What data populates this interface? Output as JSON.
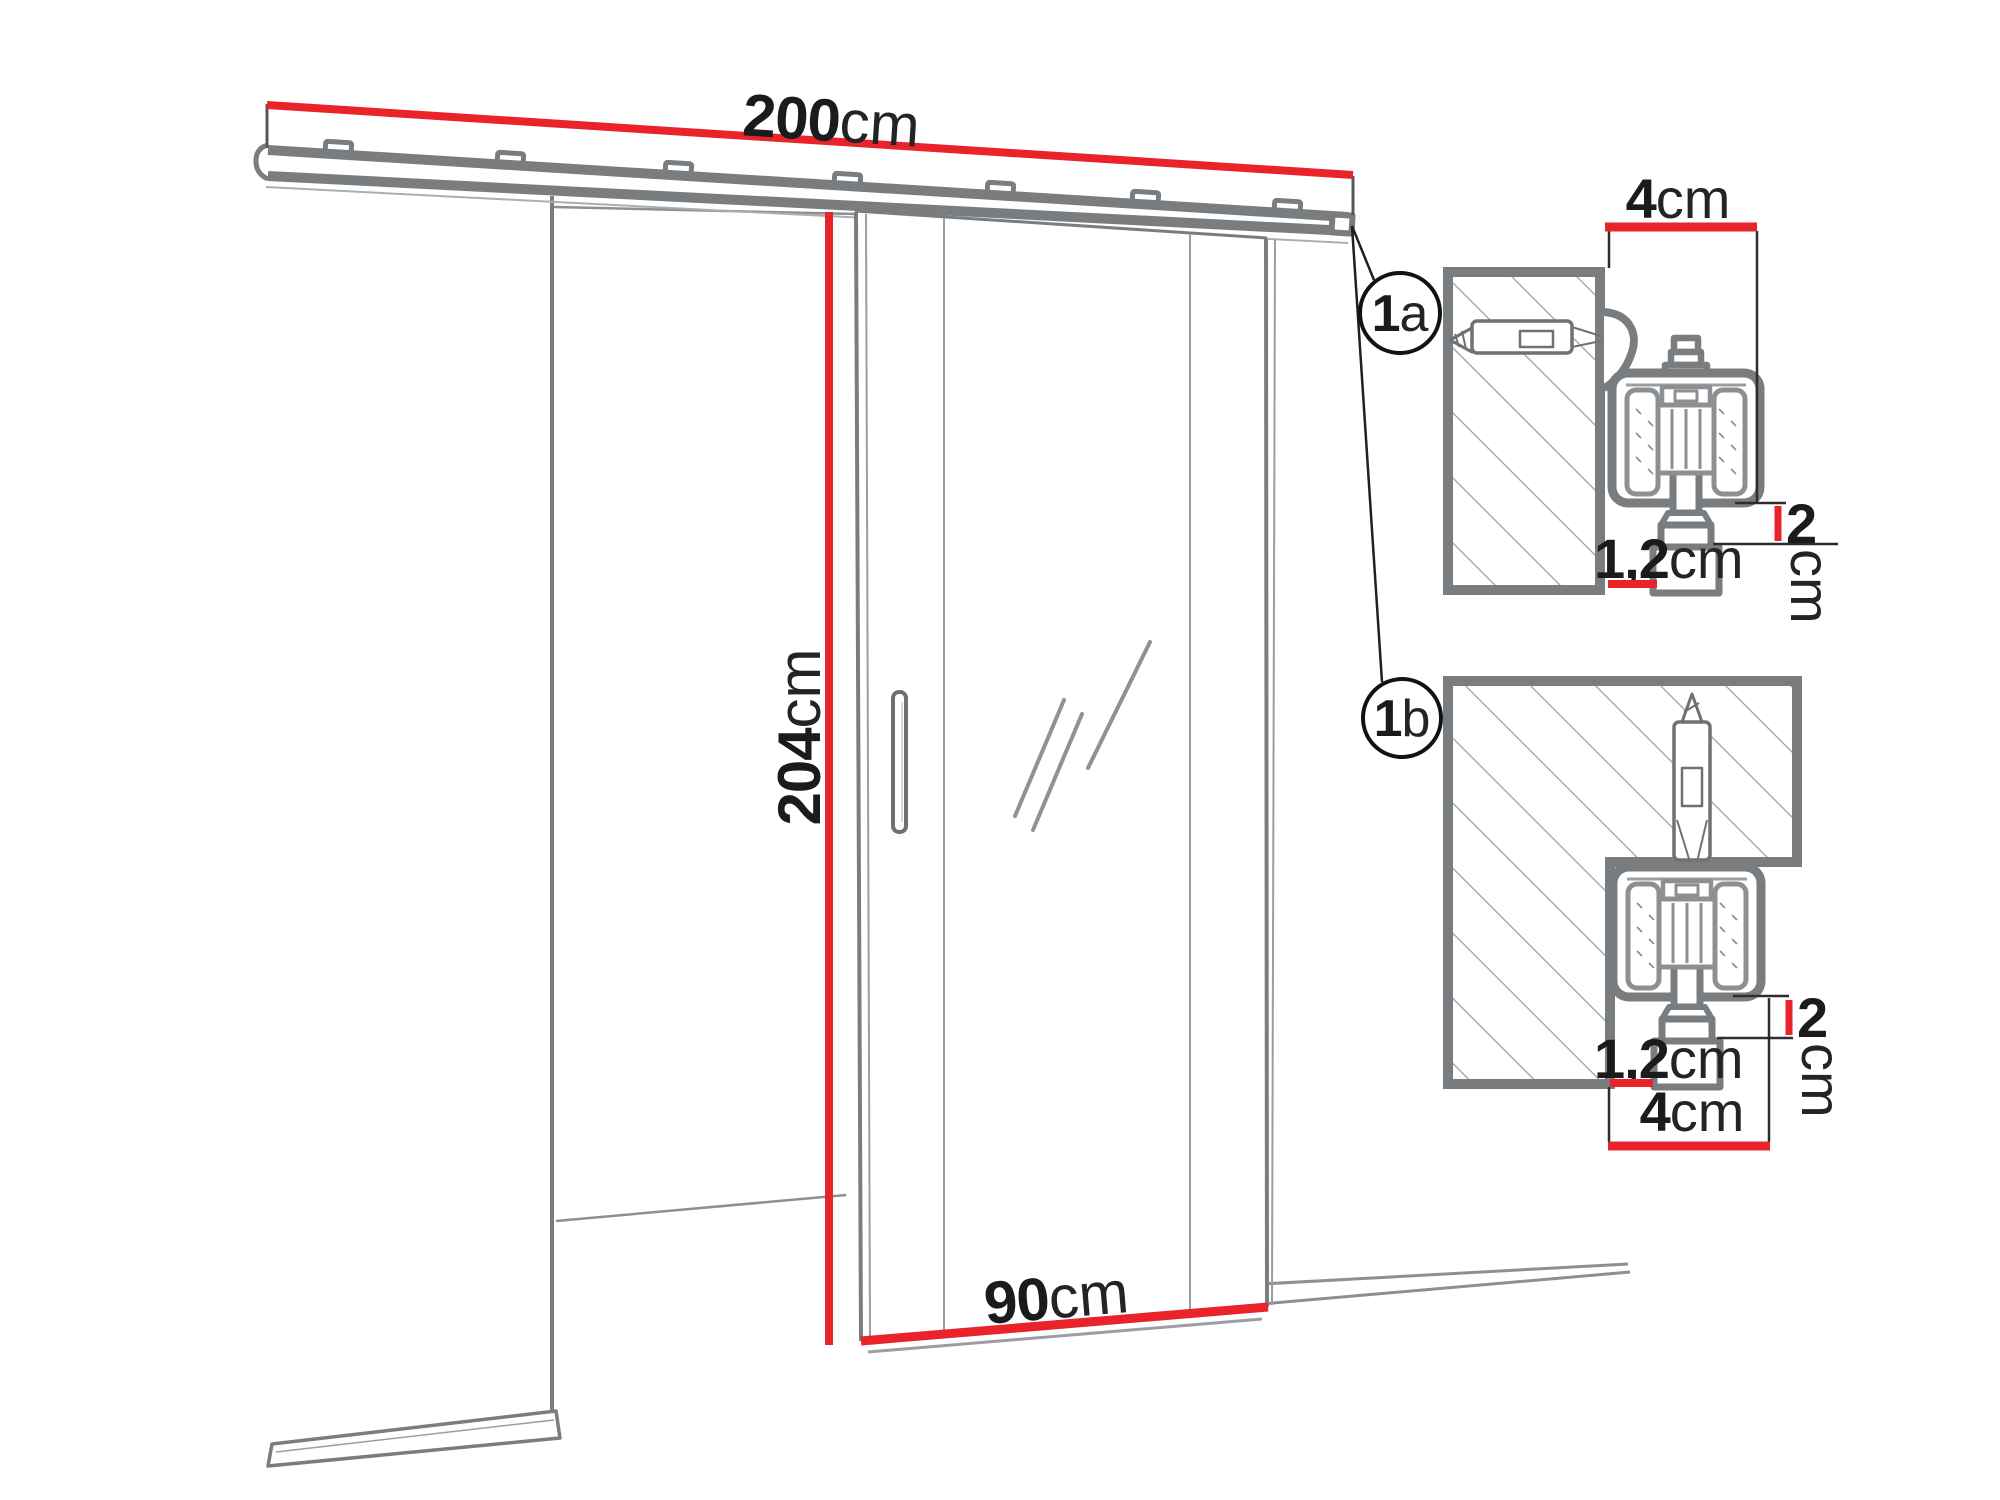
{
  "diagram": {
    "main_view": {
      "track_length": {
        "value": "200",
        "unit": "cm"
      },
      "door_height": {
        "value": "204",
        "unit": "cm"
      },
      "door_width": {
        "value": "90",
        "unit": "cm"
      }
    },
    "detail_a": {
      "label": {
        "number": "1",
        "letter": "a"
      },
      "bracket_depth": {
        "value": "4",
        "unit": "cm"
      },
      "clearance": {
        "value": "2",
        "unit": "cm"
      },
      "offset": {
        "value": "1,2",
        "unit": "cm"
      }
    },
    "detail_b": {
      "label": {
        "number": "1",
        "letter": "b"
      },
      "track_width": {
        "value": "4",
        "unit": "cm"
      },
      "clearance": {
        "value": "2",
        "unit": "cm"
      },
      "offset": {
        "value": "1,2",
        "unit": "cm"
      }
    },
    "colors": {
      "dimension_red": "#e8232a",
      "outline_gray": "#7a7d80",
      "hatch_gray": "#9b9ea1",
      "text_black": "#1a1b1c"
    }
  }
}
